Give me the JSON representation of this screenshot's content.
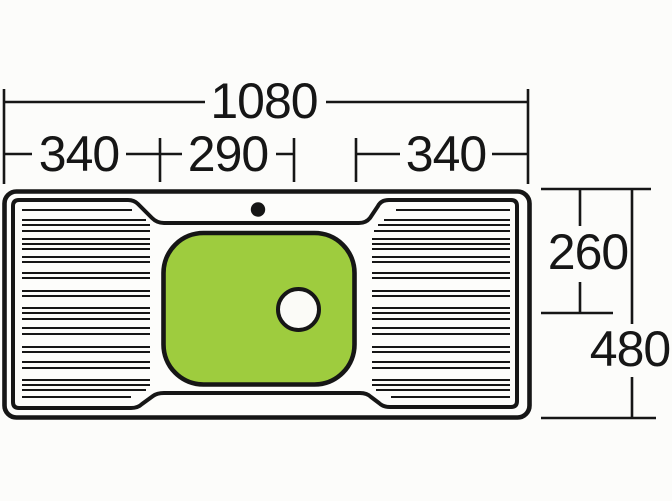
{
  "diagram": {
    "type": "technical-drawing",
    "subject": "inset-sink-plan-view",
    "labels": {
      "overall_width": "1080",
      "left_drainer_width": "340",
      "bowl_width": "290",
      "right_drainer_width": "340",
      "bowl_depth": "260",
      "overall_depth": "480"
    },
    "colors": {
      "bowl": "#9ecc3e",
      "line": "#161616",
      "paper": "#fcfcfa",
      "drain": "#fbfbf7"
    }
  }
}
